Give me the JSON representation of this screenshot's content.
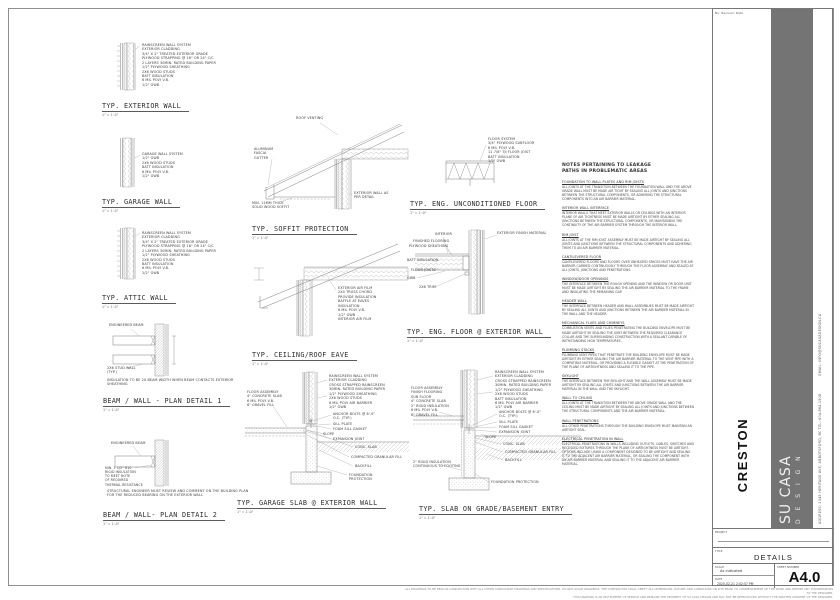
{
  "titleblock": {
    "rev_header": "No.    Revision    Date",
    "client": "CRESTON",
    "brand": "SU CASA",
    "brand_sub": "D E S I G N",
    "address": "ADDRESS: 2345 HERITAGE AVE, ABBOTSFORD, BC    TEL: 604.864.1908",
    "email": "EMAIL: INFO@SUCASADESIGN.CA",
    "project_label": "PROJECT",
    "title_label": "TITLE",
    "sheet_title": "DETAILS",
    "scale_label": "SCALE",
    "scale_value": "As indicated",
    "date_label": "DATE",
    "date_value": "2020-02-21 2:02:57 PM",
    "sheet_no_label": "SHEET NUMBER",
    "sheet_no": "A4.0",
    "gray_bar_color": "#747474"
  },
  "disclaimer": {
    "line1": "ALL DRAWINGS TO BE READ IN CONJUNCTION WITH ALL OTHER CONSULTANT DRAWINGS AND SPECIFICATIONS. DO NOT SCALE DRAWINGS. THE CONTRACTOR SHALL VERIFY ALL DIMENSIONS, DATUMS AND CONDITIONS ON SITE PRIOR TO COMMENCEMENT OF THE WORK AND REPORT ANY DISCREPANCIES TO THE DESIGNER.",
    "line2": "THIS DRAWING IS AN INSTRUMENT OF SERVICE AND REMAINS THE PROPERTY OF SU CASA DESIGN AND MAY NOT BE REPRODUCED WITHOUT THE WRITTEN CONSENT OF THE DESIGNER."
  },
  "notes_column": {
    "heading": "NOTES PERTAINING TO LEAKAGE PATHS IN PROBLEMATIC AREAS",
    "sections": [
      {
        "h": "FOUNDATION TO WALL PLATES AND RIM JOISTS",
        "b": "ALL JOINTS AT THE TRANSITION BETWEEN THE FOUNDATION WALL AND THE ABOVE GRADE WALL MUST BE MADE AIR TIGHT BY SEALING ALL JOINTS AND JUNCTIONS BETWEEN THE STRUCTURAL COMPONENTS, OR ADHERING THE STRUCTURAL COMPONENTS INTO AN AIR BARRIER MATERIAL."
      },
      {
        "h": "INTERIOR WALL INTERFACE",
        "b": "INTERIOR WALLS THAT MEET EXTERIOR WALLS OR CEILINGS WITH AN INTERIOR PLANE OF AIR TIGHTNESS MUST BE MADE AIRTIGHT BY EITHER SEALING ALL JUNCTIONS BETWEEN THE STRUCTURAL COMPONENTS, OR MAINTAINING THE CONTINUITY OF THE AIR BARRIER SYSTEM THROUGH THE INTERIOR WALL."
      },
      {
        "h": "RIM JOIST",
        "b": "ALL JOINTS AT THE RIM JOIST ASSEMBLY MUST BE MADE AIRTIGHT BY SEALING ALL JOINTS AND JUNCTIONS BETWEEN THE STRUCTURAL COMPONENTS AND ADHERING THEM TO AN AIR BARRIER MATERIAL."
      },
      {
        "h": "CANTILEVERED FLOOR",
        "b": "CANTILEVERED FLOORS AND FLOORS OVER UNHEATED SPACES MUST HAVE THE AIR BARRIER CARRIED CONTINUOUSLY THROUGH THE FLOOR ASSEMBLY AND SEALED AT ALL JOINTS, JUNCTIONS AND PENETRATIONS."
      },
      {
        "h": "WINDOW/DOOR OPENINGS",
        "b": "THE INTERFACE BETWEEN THE ROUGH OPENING AND THE WINDOW OR DOOR UNIT MUST BE MADE AIRTIGHT BY SEALING THE AIR BARRIER MATERIAL TO THE FRAME AND INSULATING THE REMAINING GAP."
      },
      {
        "h": "HEADER WALL",
        "b": "THE INTERFACE BETWEEN HEADER AND WALL ASSEMBLIES MUST BE MADE AIRTIGHT BY SEALING ALL JOINTS AND JUNCTIONS BETWEEN THE AIR BARRIER MATERIAL IN THE WALL AND THE HEADER."
      },
      {
        "h": "MECHANICAL FLUES AND CHIMNEYS",
        "b": "COMBUSTION VENTS AND FLUES PENETRATING THE BUILDING ENVELOPE MUST BE MADE AIRTIGHT BY SEALING THE JOINT BETWEEN THE REQUIRED CLEARANCE COLLAR AND THE SURROUNDING CONSTRUCTION WITH A SEALANT CAPABLE OF WITHSTANDING HIGH TEMPERATURES."
      },
      {
        "h": "PLUMBING STACKS",
        "b": "PLUMBING VENT PIPES THAT PENETRATE THE BUILDING ENVELOPE MUST BE MADE AIRTIGHT BY EITHER SEALING THE AIR BARRIER MATERIAL TO THE VENT PIPE WITH A COMPATIBLE MATERIAL, OR PROVIDING A FLEXIBLE GASKET AT THE PENETRATION OF THE PLANE OF AIRTIGHTNESS AND SEALING IT TO THE PIPE."
      },
      {
        "h": "SKYLIGHT",
        "b": "THE INTERFACE BETWEEN THE SKYLIGHT AND THE WALL ASSEMBLY MUST BE MADE AIRTIGHT BY SEALING ALL JOINTS AND JUNCTIONS BETWEEN THE AIR BARRIER MATERIAL IN THE WALL AND THE SKYLIGHT."
      },
      {
        "h": "WALL TO CEILING",
        "b": "ALL JOINTS AT THE TRANSITION BETWEEN THE ABOVE GRADE WALL AND THE CEILING MUST BE MADE AIRTIGHT BY SEALING ALL JOINTS AND JUNCTIONS BETWEEN THE STRUCTURAL COMPONENTS AND THE AIR BARRIER MATERIAL."
      },
      {
        "h": "WALL PENETRATIONS",
        "b": "ALL OTHER PENETRATIONS THROUGH THE BUILDING ENVELOPE MUST MAINTAIN AN AIRTIGHT SEAL."
      },
      {
        "h": "ELECTRICAL PENETRATION IN WALL",
        "b": "ELECTRICAL PENETRATIONS IN WALLS INCLUDING OUTLETS, CABLES, SWITCHES AND RECESSED FIXTURES THROUGH THE PLANE OF AIRTIGHTNESS MUST BE AIRTIGHT. OPTIONS INCLUDE USING A COMPONENT DESIGNED TO BE AIRTIGHT AND SEALING IT TO THE ADJACENT AIR BARRIER MATERIAL, OR SEALING THE COMPONENT WITH AN AIR BARRIER MATERIAL AND SEALING IT TO THE ADJACENT AIR BARRIER MATERIAL."
      }
    ]
  },
  "details": {
    "common_scale": "1\" = 1'-0\"",
    "exterior_wall": {
      "title": "TYP. EXTERIOR WALL",
      "scale": "1\" = 1'-0\"",
      "assembly": [
        "RAINSCREEN WALL SYSTEM",
        "EXTERIOR CLADDING",
        "3/4\" X 2\" TREATED EXTERIOR GRADE",
        "PLYWOOD STRAPPING @ 16\" OR 24\" C/C",
        "2 LAYERS 30MIN. RATED BUILDING PAPER",
        "1/2\" PLYWOOD SHEATHING",
        "2X6 WOOD STUDS",
        "BATT INSULATION",
        "6 MIL POLY V.B.",
        "1/2\" GWB"
      ]
    },
    "garage_wall": {
      "title": "TYP. GARAGE WALL",
      "scale": "1\" = 1'-0\"",
      "assembly": [
        "GARAGE WALL SYSTEM",
        "1/2\" GWB",
        "2X6 WOOD STUDS",
        "BATT INSULATION",
        "6 MIL POLY V.B.",
        "1/2\" GWB"
      ]
    },
    "attic_wall": {
      "title": "TYP. ATTIC WALL",
      "scale": "1\" = 1'-0\"",
      "assembly": [
        "RAINSCREEN WALL SYSTEM",
        "EXTERIOR CLADDING",
        "3/4\" X 2\" TREATED EXTERIOR GRADE",
        "PLYWOOD STRAPPING @ 16\" OR 24\" C/C",
        "2 LAYERS 30MIN. RATED BUILDING PAPER",
        "1/2\" PLYWOOD SHEATHING",
        "2X6 WOOD STUDS",
        "BATT INSULATION",
        "6 MIL POLY V.B.",
        "1/2\" GWB"
      ]
    },
    "plan1": {
      "title": "BEAM / WALL - PLAN DETAIL 1",
      "scale": "1\" = 1'-0\"",
      "beam_label": "ENGINEERED BEAM",
      "wall_label": [
        "2X6 STUD WALL",
        "(TYP.)"
      ],
      "note": "INSULATION TO BE 2X BEAM WIDTH WHEN BEAM CONTACTS EXTERIOR SHEATHING"
    },
    "plan2": {
      "title": "BEAM / WALL- PLAN DETAIL 2",
      "scale": "1\" = 1'-0\"",
      "beam_label": "ENGINEERED BEAM",
      "pad": [
        "MIN. 1 1/2\" R10",
        "RIGID INSULATION",
        "TO MEET NOTE",
        "OF REQUIRED",
        "THERMAL RESISTANCE"
      ],
      "note": "STRUCTURAL ENGINEER MUST REVIEW AND COMMENT ON THE BUILDING PLAN FOR THE REDUCED BEARING ON THE EXTERIOR WALL"
    },
    "soffit": {
      "title": "TYP. SOFFIT PROTECTION",
      "scale": "1\" = 1'-0\"",
      "roof_venting": "ROOF VENTING",
      "gutter": [
        "ALUMINUM",
        "FASCIA",
        "GUTTER"
      ],
      "soffit": [
        "MIN. 11MM THICK",
        "SOLID WOOD SOFFIT"
      ],
      "wall": [
        "EXTERIOR WALL AS",
        "PER DETAIL"
      ]
    },
    "eave": {
      "title": "TYP. CEILING/ROOF EAVE",
      "scale": "1\" = 1'-0\"",
      "assembly": [
        "EXTERIOR AIR FILM",
        "2X4 TRUSS CHORD",
        "PROVIDE INSULATION",
        "BAFFLE AT EAVES",
        "INSULATION",
        "6 MIL POLY V.B.",
        "1/2\" GWB",
        "INTERIOR AIR FILM"
      ]
    },
    "garage_slab": {
      "title": "TYP. GARAGE SLAB @ EXTERIOR WALL",
      "scale": "1\" = 1'-0\"",
      "floor": [
        "FLOOR ASSEMBLY",
        "4\" CONCRETE SLAB",
        "6 MIL POLY V.B.",
        "6\" GRAVEL FILL"
      ],
      "wall": [
        "RAINSCREEN WALL SYSTEM",
        "EXTERIOR CLADDING",
        "CROSS STRAPPED RAINSCREEN",
        "30MIN. RATED BUILDING PAPER",
        "1/2\" PLYWOOD SHEATHING",
        "2X6 WOOD STUDS",
        "6 MIL POLY AIR BARRIER",
        "1/2\" GWB"
      ],
      "mid": {
        "anchor": "ANCHOR BOLTS @ 6'-0\" O.C. (TYP.)",
        "sill": "SILL PLATE",
        "gasket": "FOAM SILL GASKET",
        "slope": "SLOPE",
        "expansion": "EXPANSION JOINT"
      },
      "lower": {
        "slab": "CONC. SLAB",
        "granular": "COMPACTED GRANULAR FILL",
        "backfill": "BACKFILL",
        "protection": "FOUNDATION PROTECTION"
      }
    },
    "uncond_floor": {
      "title": "TYP. ENG. UNCONDITIONED FLOOR",
      "scale": "1\" = 1'-0\"",
      "assembly": [
        "FLOOR SYSTEM",
        "3/4\" PLYWOOD SUBFLOOR",
        "6 MIL POLY V.B.",
        "11 7/8\" TJI FLOOR JOIST",
        "BATT INSULATION",
        "1/2\" GWB"
      ]
    },
    "eng_floor": {
      "title": "TYP. ENG. FLOOR @ EXTERIOR WALL",
      "scale": "1\" = 1'-0\"",
      "left": [
        "INTERIOR",
        "FINISHED FLOORING",
        "PLYWOOD SHEATHING",
        "BATT INSULATION",
        "FLOOR JOISTS",
        "GWB",
        "2X6 TRIM"
      ],
      "right": "EXTERIOR FINISH MATERIAL"
    },
    "slab_grade": {
      "title": "TYP. SLAB ON GRADE/BASEMENT ENTRY",
      "scale": "1\" = 1'-0\"",
      "floor": [
        "FLOOR ASSEMBLY",
        "FINISH FLOORING",
        "SUB FLOOR",
        "4\" CONCRETE SLAB",
        "2\" RIGID INSULATION",
        "6 MIL POLY V.B.",
        "6\" GRAVEL FILL"
      ],
      "rigid": [
        "2\" RIGID INSULATION",
        "CONTINUOUS TO FOOTING"
      ],
      "wall": [
        "RAINSCREEN WALL SYSTEM",
        "EXTERIOR CLADDING",
        "CROSS STRAPPED RAINSCREEN",
        "30MIN. RATED BUILDING PAPER",
        "1/2\" PLYWOOD SHEATHING",
        "2X6 WOOD STUDS",
        "BATT INSULATION",
        "6 MIL POLY AIR BARRIER",
        "1/2\" GWB"
      ],
      "mid": {
        "anchor": "ANCHOR BOLTS @ 6'-0\" O.C. (TYP.)",
        "sill": "SILL PLATE",
        "gasket": "FOAM SILL GASKET",
        "slope": "SLOPE",
        "expansion": "EXPANSION JOINT"
      },
      "lower": {
        "slab": "CONC. SLAB",
        "granular": "COMPACTED GRANULAR FILL",
        "backfill": "BACKFILL",
        "protection": "FOUNDATION PROTECTION"
      }
    }
  }
}
